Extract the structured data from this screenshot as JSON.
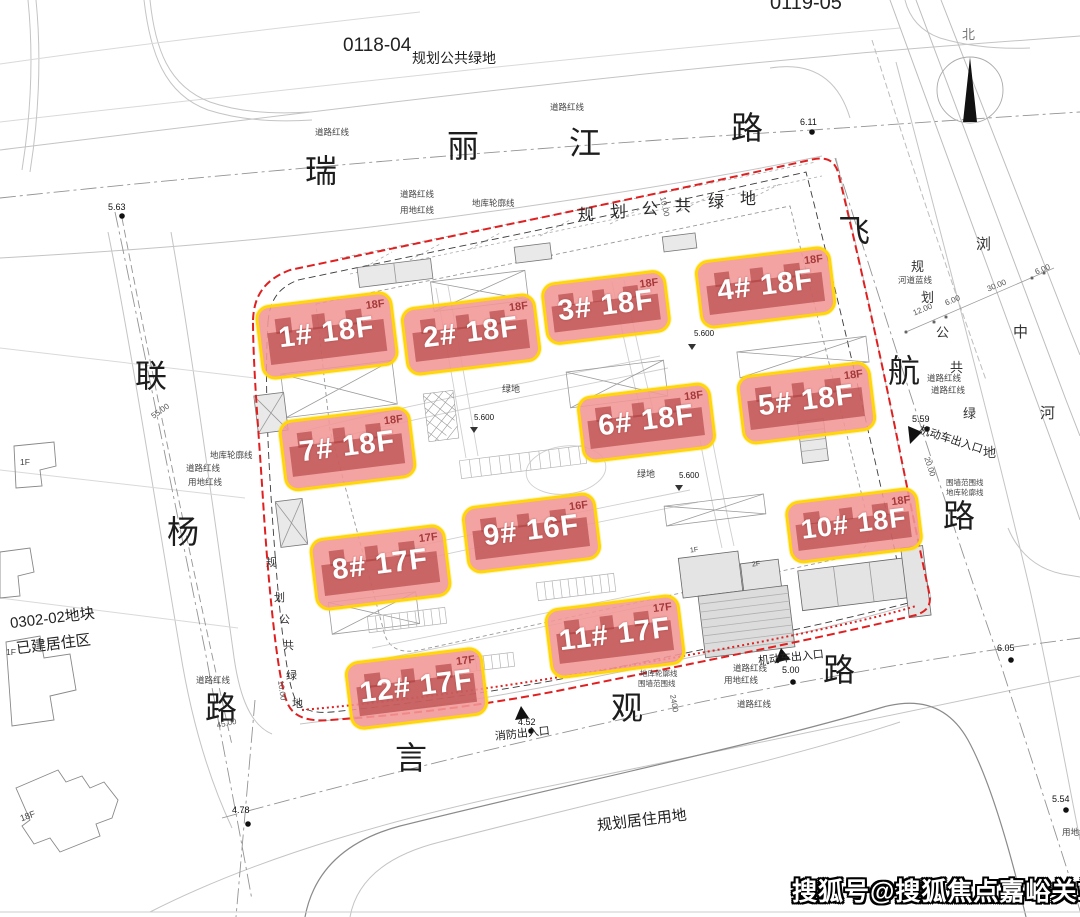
{
  "parcels": {
    "top_left_code": "0118-04",
    "top_left_use": "规划公共绿地",
    "top_right_code": "0119-05",
    "west_block_code": "0302-02地块",
    "west_block_use": "已建居住区",
    "south_use": "规划居住用地",
    "river_name_chars": [
      "浏",
      "中",
      "河"
    ],
    "green_top_chars": [
      "规",
      "划",
      "公",
      "共",
      "绿",
      "地"
    ],
    "green_west_chars": [
      "规",
      "划",
      "公",
      "共",
      "绿",
      "地"
    ],
    "green_east_chars": [
      "规",
      "划",
      "公",
      "共",
      "绿",
      "地"
    ]
  },
  "streets": {
    "north": {
      "name": "瑞丽江路",
      "chars": [
        "瑞",
        "丽",
        "江",
        "路"
      ]
    },
    "west": {
      "name": "联杨路",
      "chars": [
        "联",
        "杨",
        "路"
      ]
    },
    "east": {
      "name": "飞航路",
      "chars": [
        "飞",
        "航",
        "路"
      ]
    },
    "south": {
      "name": "言观路",
      "chars": [
        "言",
        "观",
        "路"
      ]
    }
  },
  "buildings": [
    {
      "id": "1#",
      "floors": "18F",
      "label": "1# 18F"
    },
    {
      "id": "2#",
      "floors": "18F",
      "label": "2# 18F"
    },
    {
      "id": "3#",
      "floors": "18F",
      "label": "3# 18F"
    },
    {
      "id": "4#",
      "floors": "18F",
      "label": "4# 18F"
    },
    {
      "id": "5#",
      "floors": "18F",
      "label": "5# 18F"
    },
    {
      "id": "6#",
      "floors": "18F",
      "label": "6# 18F"
    },
    {
      "id": "7#",
      "floors": "18F",
      "label": "7# 18F"
    },
    {
      "id": "8#",
      "floors": "17F",
      "label": "8# 17F"
    },
    {
      "id": "9#",
      "floors": "16F",
      "label": "9# 16F"
    },
    {
      "id": "10#",
      "floors": "18F",
      "label": "10# 18F"
    },
    {
      "id": "11#",
      "floors": "17F",
      "label": "11# 17F"
    },
    {
      "id": "12#",
      "floors": "17F",
      "label": "12# 17F"
    }
  ],
  "annotations": {
    "road_redline": "道路红线",
    "land_redline": "用地红线",
    "garage_outline": "地库轮廓线",
    "wall_line": "围墙范围线",
    "river_blueline": "河道蓝线",
    "green": "绿地",
    "fire_exit": "消防出入口",
    "vehicle_entrance": "机动车出入口",
    "north_label": "北",
    "existing_18f": "18F",
    "existing_1f": "1F",
    "facility_1f": "1F",
    "facility_2f": "2F"
  },
  "levels": {
    "l563": "5.63",
    "l611": "6.11",
    "l559": "5.59",
    "l605": "6.05",
    "l554": "5.54",
    "l478": "4.78",
    "l452": "4.52",
    "l500": "5.00",
    "spot": "5.600"
  },
  "dims": {
    "d55": "55.00",
    "d45": "45.00",
    "d10": "10.00",
    "d20": "20.00",
    "d12": "12.00",
    "d6": "6.00",
    "d30": "30.00",
    "d2400": "2400"
  },
  "watermark": "搜狐号@搜狐焦点嘉峪关站",
  "colors": {
    "boundary_red": "#e02020",
    "highlight_pink": "#f39696",
    "highlight_border": "#ffd60a",
    "footprint": "#ac3c3c"
  }
}
